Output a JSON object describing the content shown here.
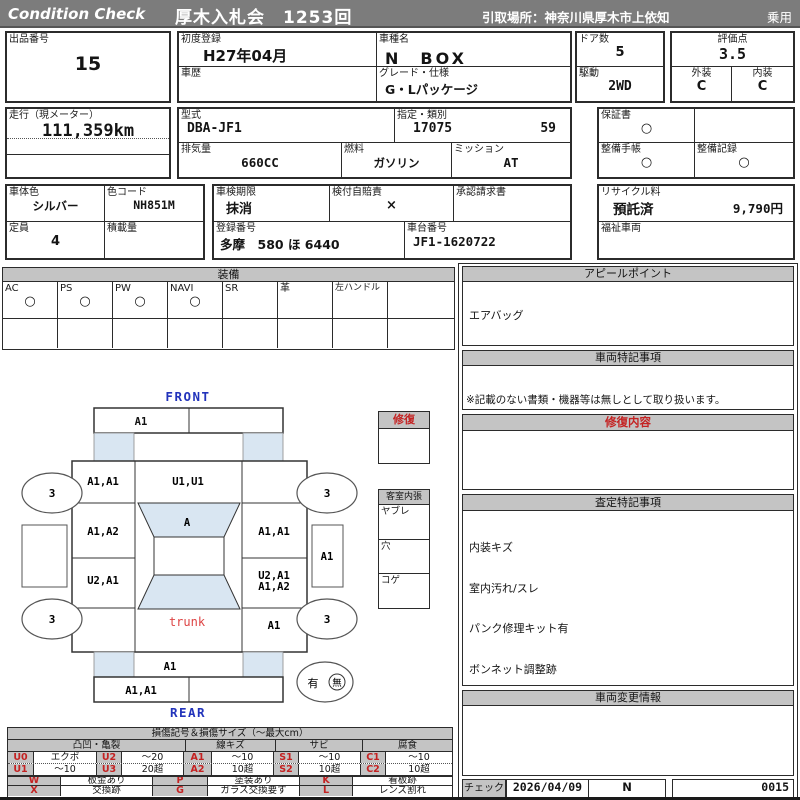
{
  "colors": {
    "header_bg": "#7c7c7c",
    "section_header_bg": "#c4c4c4",
    "accent_red": "#c42222",
    "accent_blue": "#2233bb",
    "panel_blue": "#d9e6f2"
  },
  "header": {
    "brand": "Condition  Check",
    "auction": "厚木入札会　1253回",
    "pickup": "引取場所：神奈川県厚木市上依知",
    "category": "乗用"
  },
  "info": {
    "lot": {
      "label": "出品番号",
      "value": "15"
    },
    "first_reg": {
      "label": "初度登録",
      "value": "H27年04月"
    },
    "model": {
      "label": "車種名",
      "value": "N　BOX"
    },
    "history": {
      "label": "車歴",
      "value": ""
    },
    "grade": {
      "label": "グレード・仕様",
      "value": "G・Lパッケージ"
    },
    "doors": {
      "label": "ドア数",
      "value": "5"
    },
    "score": {
      "label": "評価点",
      "value": "3.5"
    },
    "drive": {
      "label": "駆動",
      "value": "2WD"
    },
    "exterior": {
      "label": "外装",
      "value": "C"
    },
    "interior": {
      "label": "内装",
      "value": "C"
    },
    "mileage": {
      "label": "走行（現メーター）",
      "value": "111,359km"
    },
    "model_code": {
      "label": "型式",
      "value": "DBA-JF1"
    },
    "class": {
      "label": "指定・類別",
      "value1": "17075",
      "value2": "59"
    },
    "warranty": {
      "label": "保証書",
      "value": "○"
    },
    "displacement": {
      "label": "排気量",
      "value": "660CC"
    },
    "fuel": {
      "label": "燃料",
      "value": "ガソリン"
    },
    "transmission": {
      "label": "ミッション",
      "value": "AT"
    },
    "service_book": {
      "label": "整備手帳",
      "value": "○"
    },
    "service_record": {
      "label": "整備記録",
      "value": "○"
    },
    "body_color": {
      "label": "車体色",
      "value": "シルバー"
    },
    "color_code": {
      "label": "色コード",
      "value": "NH851M"
    },
    "inspection": {
      "label": "車検期限",
      "value": "抹消"
    },
    "insurance": {
      "label": "検付自賠責",
      "value": "×"
    },
    "approval": {
      "label": "承認請求書",
      "value": ""
    },
    "recycle": {
      "label": "リサイクル料",
      "status": "預託済",
      "fee": "9,790円"
    },
    "capacity": {
      "label": "定員",
      "value": "4"
    },
    "load": {
      "label": "積載量",
      "value": ""
    },
    "reg_no": {
      "label": "登録番号",
      "value": "多摩　580 ほ 6440"
    },
    "chassis": {
      "label": "車台番号",
      "value": "JF1-1620722"
    },
    "welfare": {
      "label": "福祉車両",
      "value": ""
    }
  },
  "equipment": {
    "title": "装備",
    "items": [
      {
        "label": "AC",
        "value": "○"
      },
      {
        "label": "PS",
        "value": "○"
      },
      {
        "label": "PW",
        "value": "○"
      },
      {
        "label": "NAVI",
        "value": "○"
      },
      {
        "label": "SR",
        "value": ""
      },
      {
        "label": "革",
        "value": ""
      },
      {
        "label": "左ハンドル",
        "value": ""
      }
    ]
  },
  "diagram": {
    "front": "FRONT",
    "rear": "REAR",
    "trunk": "trunk",
    "panels": {
      "front_bumper_left": "A1",
      "fender_front_left": "A1,A1",
      "hood": "U1,U1",
      "door_front_left": "A1,A2",
      "windshield": "A",
      "door_front_right": "A1,A1",
      "door_rear_left": "U2,A1",
      "door_rear_right_line1": "U2,A1",
      "door_rear_right_line2": "A1,A2",
      "quarter_rear_right": "A1",
      "side_right": "A1",
      "rear_panel": "A1",
      "rear_bumper_left": "A1,A1"
    },
    "wheels": {
      "front_left": "3",
      "front_right": "3",
      "rear_left": "3",
      "rear_right": "3"
    },
    "spare": {
      "yes": "有",
      "no": "無"
    }
  },
  "repair_box": {
    "title": "修復"
  },
  "cabin_box": {
    "title": "客室内張",
    "rows": [
      "ヤブレ",
      "穴",
      "コゲ"
    ]
  },
  "right_column": {
    "appeal": {
      "title": "アピールポイント",
      "lines": [
        "エアバッグ",
        "ABS、ETC",
        "プッシュスタート",
        "左側パワースライドドア",
        "バックカメラ付き"
      ]
    },
    "special_notes": {
      "title": "車両特記事項",
      "note": "※記載のない書類・機器等は無しとして取り扱います。"
    },
    "repair_detail": {
      "title": "修復内容"
    },
    "assessment": {
      "title": "査定特記事項",
      "lines": [
        "内装キズ",
        "室内汚れ/スレ",
        "パンク修理キット有",
        "ボンネット調整跡",
        "ドアミラー左右キズ",
        "ホイールカバーキズ"
      ]
    },
    "change_info": {
      "title": "車両変更情報"
    },
    "check": {
      "label": "チェック",
      "date": "2026/04/09",
      "code": "N",
      "number": "0015"
    }
  },
  "legend": {
    "title": "損傷記号＆損傷サイズ（～最大cm）",
    "groups": [
      "凸凹・亀裂",
      "線キズ",
      "サビ",
      "腐食"
    ],
    "rows": [
      [
        {
          "code": "U0",
          "size": "エクボ"
        },
        {
          "code": "U2",
          "size": "～20"
        },
        {
          "code": "A1",
          "size": "～10"
        },
        {
          "code": "S1",
          "size": "～10"
        },
        {
          "code": "C1",
          "size": "～10"
        }
      ],
      [
        {
          "code": "U1",
          "size": "～10"
        },
        {
          "code": "U3",
          "size": "20超"
        },
        {
          "code": "A2",
          "size": "10超"
        },
        {
          "code": "S2",
          "size": "10超"
        },
        {
          "code": "C2",
          "size": "10超"
        }
      ]
    ],
    "marks": [
      [
        {
          "code": "W",
          "desc": "板金あり"
        },
        {
          "code": "P",
          "desc": "塗装あり"
        },
        {
          "code": "K",
          "desc": "看板跡"
        }
      ],
      [
        {
          "code": "X",
          "desc": "交換跡"
        },
        {
          "code": "G",
          "desc": "ガラス交換要す"
        },
        {
          "code": "L",
          "desc": "レンズ割れ"
        }
      ]
    ]
  }
}
